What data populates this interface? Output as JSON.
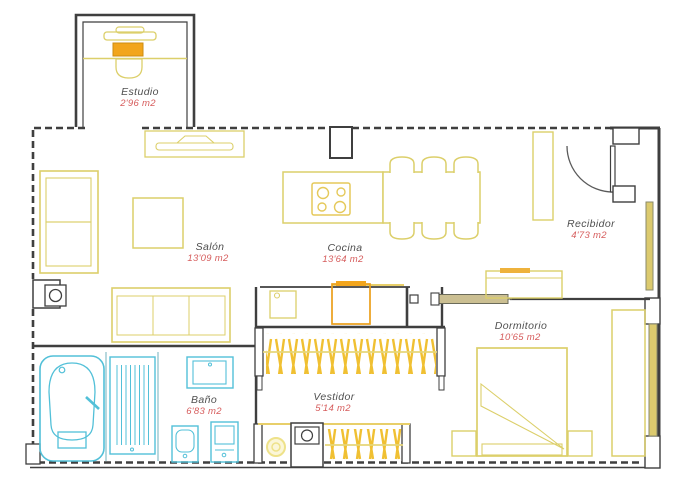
{
  "plan_title": "Apartment floor plan",
  "rooms": {
    "estudio": {
      "name": "Estudio",
      "area": "2'96 m2"
    },
    "salon": {
      "name": "Salón",
      "area": "13'09 m2"
    },
    "cocina": {
      "name": "Cocina",
      "area": "13'64 m2"
    },
    "recibidor": {
      "name": "Recibidor",
      "area": "4'73 m2"
    },
    "dormitorio": {
      "name": "Dormitorio",
      "area": "10'65 m2"
    },
    "bano": {
      "name": "Baño",
      "area": "6'83 m2"
    },
    "vestidor": {
      "name": "Vestidor",
      "area": "5'14 m2"
    }
  },
  "colors": {
    "wall": "#3f3f3f",
    "furniture_outline": "#dccf6a",
    "furniture_bright": "#f0c032",
    "furniture_accent": "#f2a51c",
    "bath_fixtures": "#52c0d8",
    "room_name_text": "#4f4f4f",
    "room_area_text": "#d65c5c",
    "background": "#ffffff"
  }
}
